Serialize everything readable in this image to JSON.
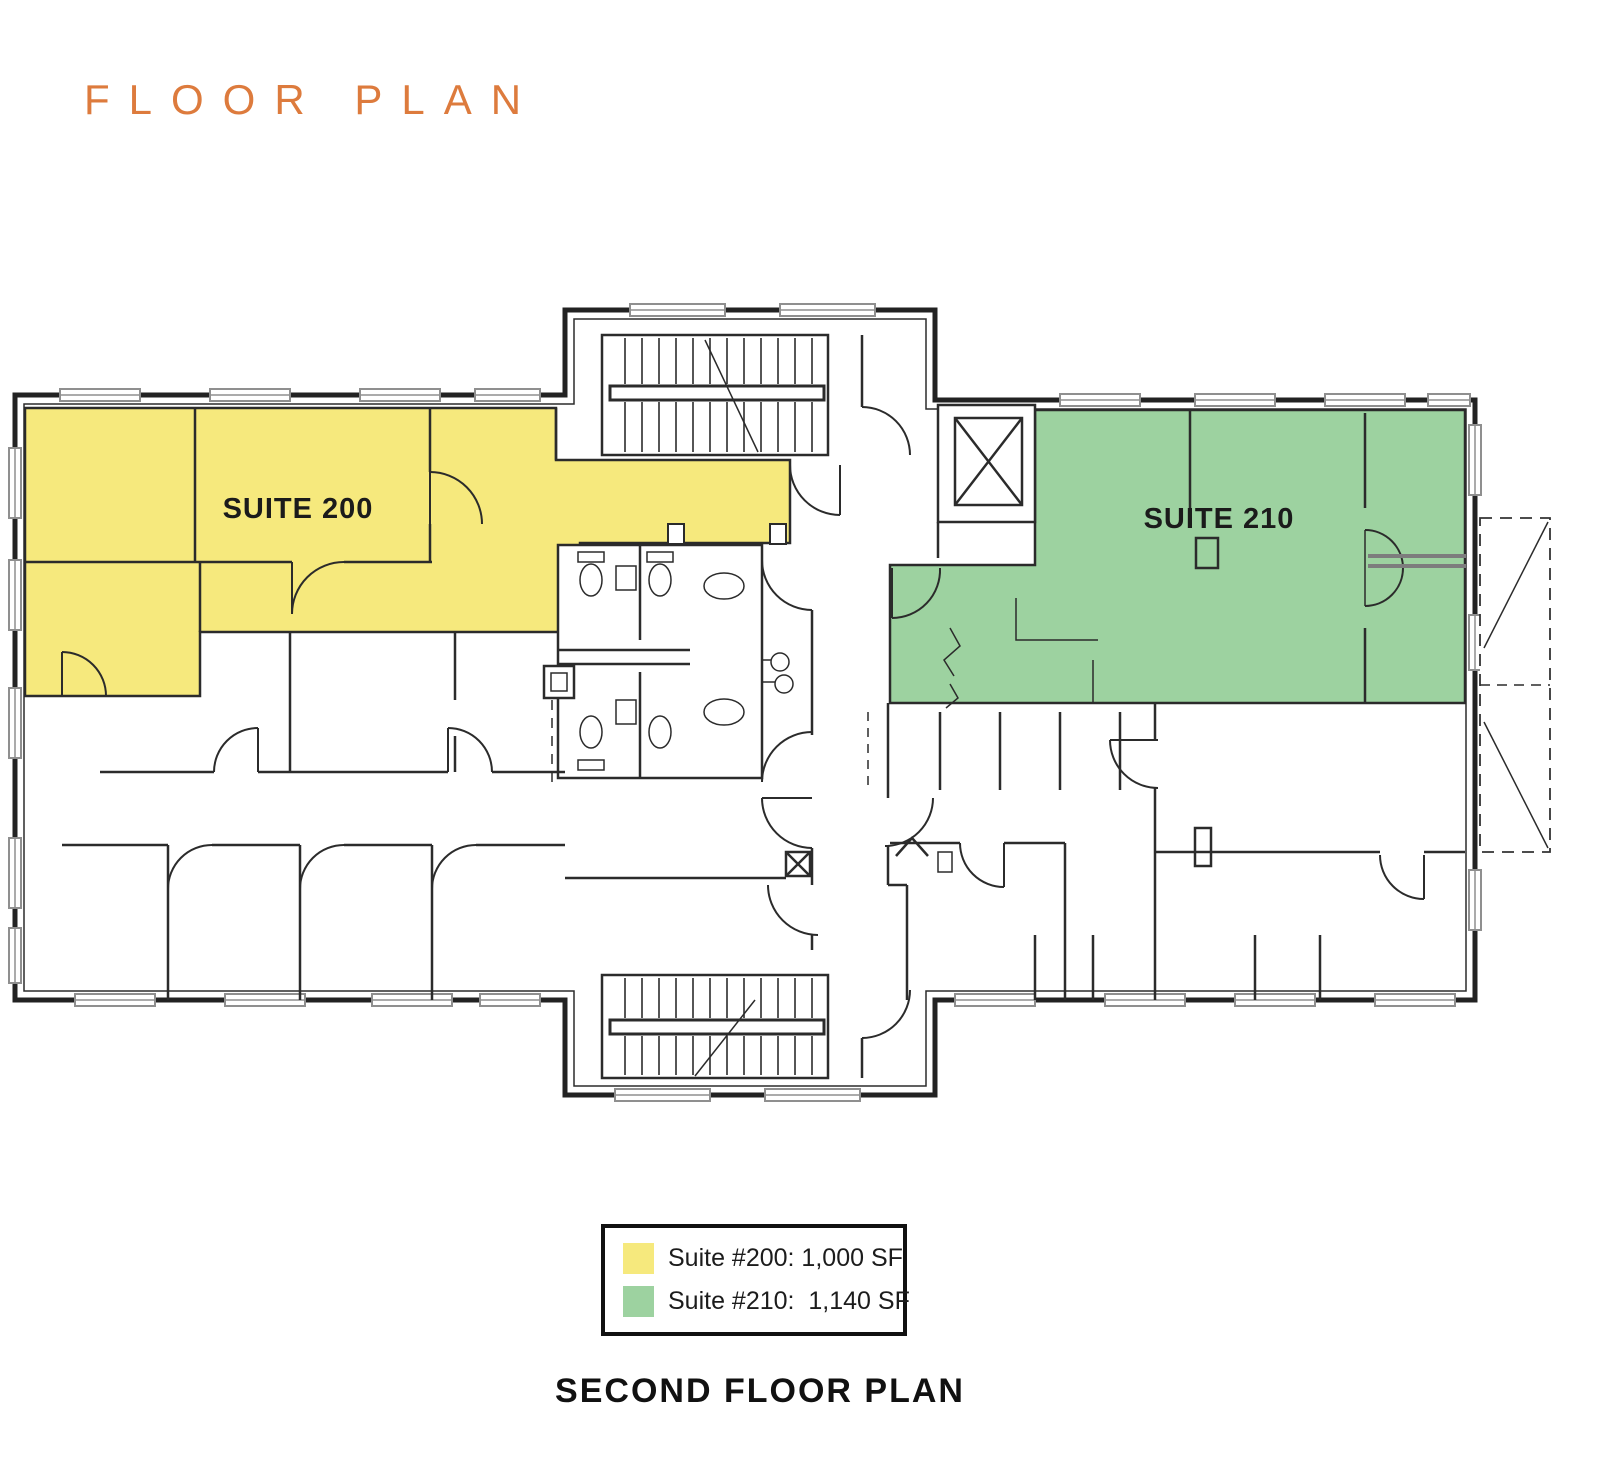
{
  "title": "FLOOR PLAN",
  "title_color": "#dd7b3d",
  "plan": {
    "suite_200": {
      "label": "SUITE 200",
      "fill": "#f6e97d"
    },
    "suite_210": {
      "label": "SUITE 210",
      "fill": "#9dd2a0"
    }
  },
  "legend": {
    "items": [
      {
        "label": "Suite #200: 1,000 SF",
        "color": "#f6e97d"
      },
      {
        "label": "Suite #210:  1,140 SF",
        "color": "#9dd2a0"
      }
    ]
  },
  "caption": "SECOND FLOOR PLAN",
  "icons": {
    "elevator": "elevator-x-icon",
    "stairs_top": "staircase-icon",
    "stairs_bottom": "staircase-icon"
  }
}
